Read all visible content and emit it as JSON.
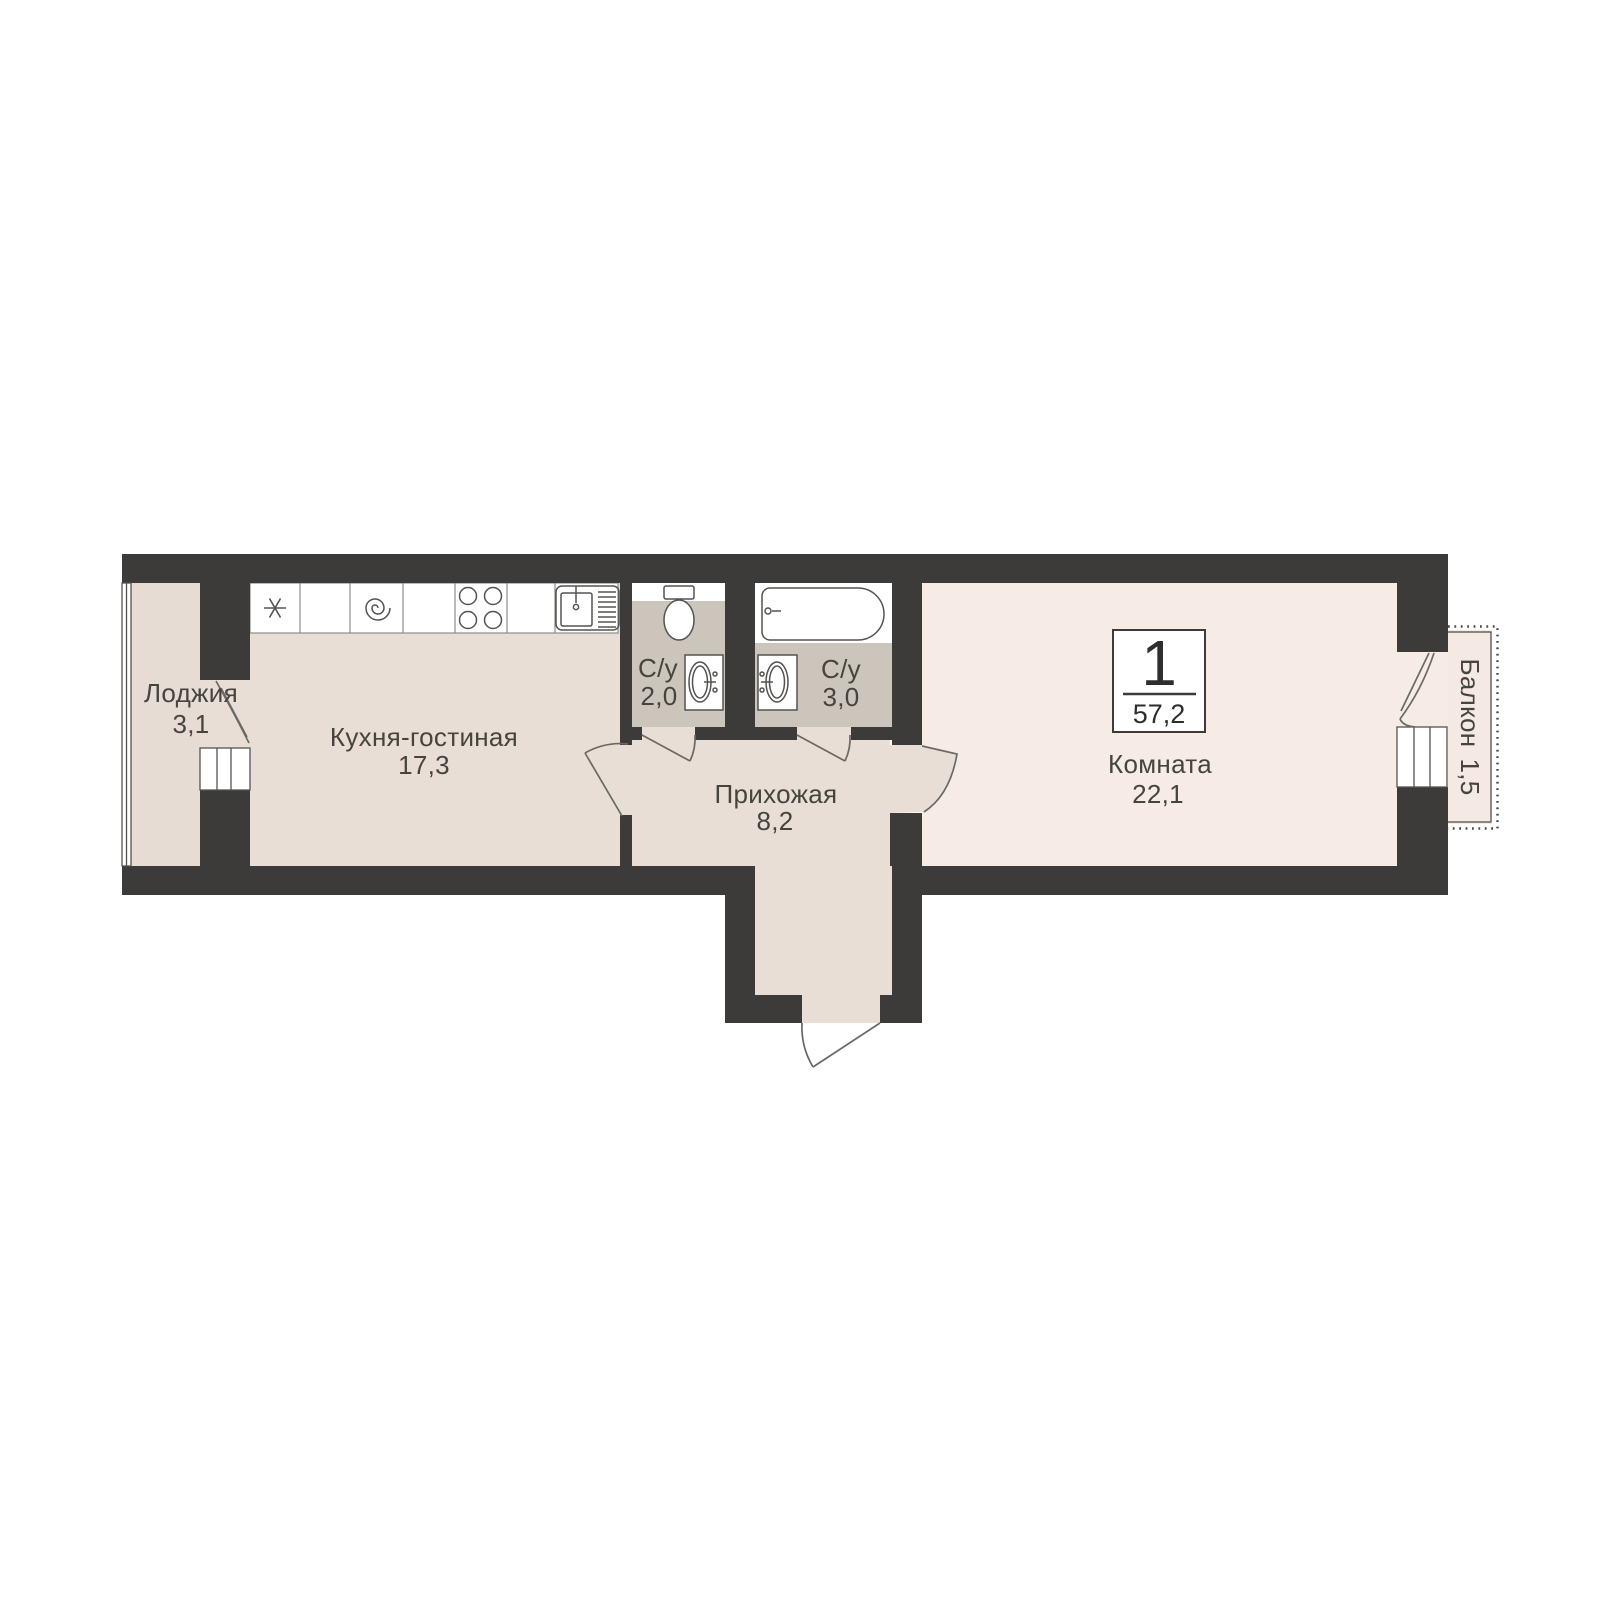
{
  "floorplan": {
    "badge": {
      "room_count": "1",
      "total_area": "57,2"
    },
    "rooms": {
      "loggia": {
        "name": "Лоджия",
        "area": "3,1"
      },
      "kitchen_living": {
        "name": "Кухня-гостиная",
        "area": "17,3"
      },
      "bathroom_small": {
        "name": "С/у",
        "area": "2,0"
      },
      "bathroom_large": {
        "name": "С/у",
        "area": "3,0"
      },
      "hallway": {
        "name": "Прихожая",
        "area": "8,2"
      },
      "room": {
        "name": "Комната",
        "area": "22,1"
      },
      "balcony": {
        "name": "Балкон",
        "area": "1,5"
      }
    },
    "colors": {
      "wall": "#3c3b39",
      "floor_main": "#e9ded5",
      "floor_loggia": "#e7dcd3",
      "floor_room": "#f6ebe5",
      "floor_balcony": "#f4e9e3",
      "floor_bathroom": "#ccc5bb",
      "text": "#45443f"
    },
    "fixtures": [
      "fridge-icon",
      "washing-machine-icon",
      "stove-icon",
      "kitchen-sink-icon",
      "toilet-icon",
      "washbasin-icon",
      "washbasin-icon",
      "bathtub-icon"
    ]
  }
}
